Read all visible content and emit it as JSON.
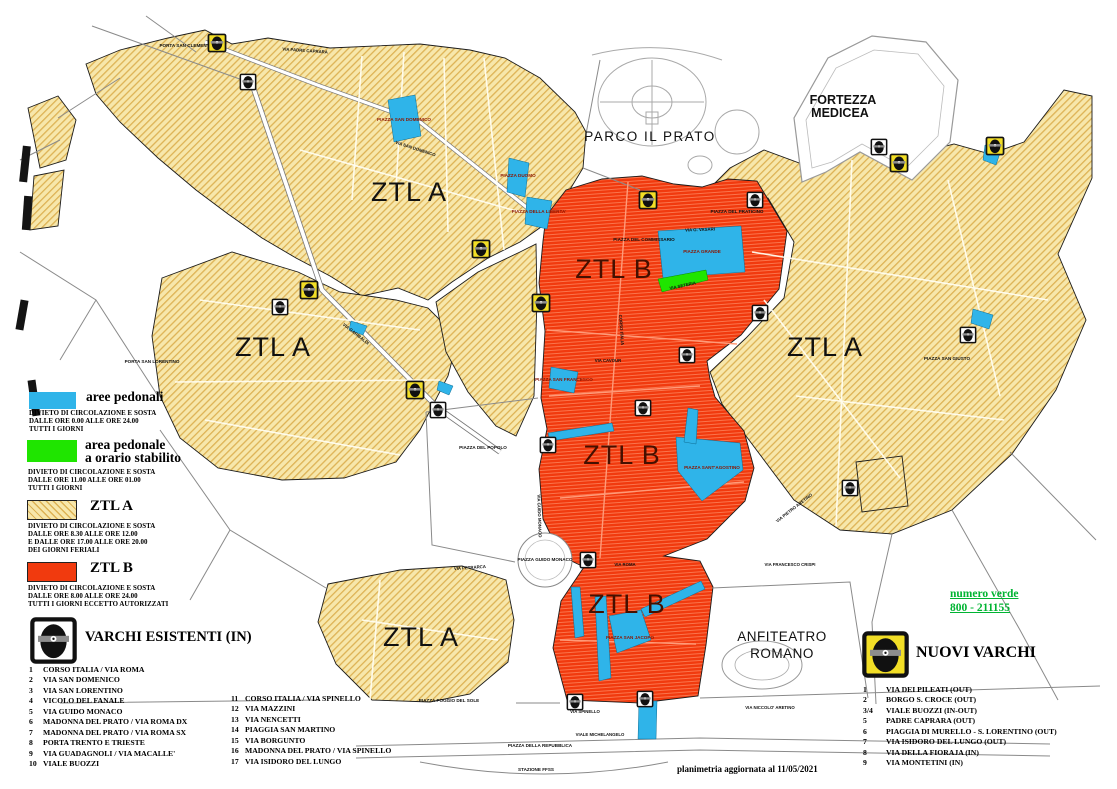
{
  "colors": {
    "aree_pedonali_blue": "#2FB4E9",
    "area_pedonale_green": "#1FE500",
    "ztl_a_yellow": "#F7E7AB",
    "ztl_a_hatch": "#DDB254",
    "ztl_b_red": "#F13A0E",
    "numero_verde_green": "#00B432",
    "varco_icon_bg_existing": "#FFFFFF",
    "varco_icon_bg_new": "#F2DE26"
  },
  "map": {
    "labels": {
      "ztl_a": "ZTL A",
      "ztl_b": "ZTL B",
      "parco": "PARCO  IL  PRATO",
      "fortezza_line1": "FORTEZZA",
      "fortezza_line2": "MEDICEA",
      "anfiteatro_line1": "ANFITEATRO",
      "anfiteatro_line2": "ROMANO"
    },
    "places": [
      "PORTA SAN CLEMENTE",
      "PIAZZA SAN DOMENICO",
      "PIAZZA DUOMO",
      "PIAZZA DELLA LIBERTA'",
      "PIAZZA DEL COMMISSARIO",
      "PIAZZA DEL PRATICINO",
      "PIAZZA GRANDE",
      "PIAZZA SAN FRANCESCO",
      "PIAZZA SANT'AGOSTINO",
      "PIAZZA DEL POPOLO",
      "PIAZZA GUIDO MONACO",
      "PIAZZA SAN JACOPO",
      "PIAZZA DELLA REPUBBLICA",
      "STAZIONE FFSS",
      "PIAZZA POGGIO DEL SOLE",
      "PIAZZA SAN GIUSTO",
      "PORTA SAN LORENTINO"
    ],
    "streets": [
      "VIA PADRE CAPRARA",
      "VIA SAN DOMENICO",
      "VIA GARIBALDI",
      "CORSO ITALIA",
      "VIA G. VASARI",
      "VIA SETERIA",
      "VIA CAVOUR",
      "VIA ROMA",
      "VIA SPINELLO",
      "VIALE MICHELANGELO",
      "VIA PETRARCA",
      "VIA FRANCESCO CRISPI",
      "VIA NICCOLO' ARETINO",
      "VIA PIETRO ARETINO",
      "VIA GUIDO MONACO"
    ]
  },
  "legend": {
    "items": [
      {
        "title": "aree pedonali",
        "lines": [
          "DIVIETO DI CIRCOLAZIONE E SOSTA",
          "DALLE ORE 0.00 ALLE ORE 24.00",
          "TUTTI I GIORNI"
        ]
      },
      {
        "title": "area pedonale",
        "title2": "a orario stabilito",
        "lines": [
          "DIVIETO DI CIRCOLAZIONE E SOSTA",
          "DALLE ORE 11.00 ALLE ORE 01.00",
          "TUTTI I GIORNI"
        ]
      },
      {
        "title": "ZTL A",
        "lines": [
          "DIVIETO DI CIRCOLAZIONE E SOSTA",
          "DALLE ORE 8.30 ALLE ORE 12.00",
          "E DALLE ORE 17.00 ALLE ORE 20.00",
          "DEI GIORNI FERIALI"
        ]
      },
      {
        "title": "ZTL B",
        "lines": [
          "DIVIETO DI CIRCOLAZIONE E SOSTA",
          "DALLE ORE 8.00 ALLE ORE 24.00",
          "TUTTI I GIORNI ECCETTO AUTORIZZATI"
        ]
      }
    ]
  },
  "varchi_esistenti": {
    "title": "VARCHI ESISTENTI (IN)",
    "col1": [
      {
        "n": "1",
        "name": "CORSO ITALIA / VIA ROMA"
      },
      {
        "n": "2",
        "name": "VIA SAN DOMENICO"
      },
      {
        "n": "3",
        "name": "VIA SAN LORENTINO"
      },
      {
        "n": "4",
        "name": "VICOLO DEL FANALE"
      },
      {
        "n": "5",
        "name": "VIA GUIDO MONACO"
      },
      {
        "n": "6",
        "name": "MADONNA DEL PRATO / VIA ROMA DX"
      },
      {
        "n": "7",
        "name": "MADONNA DEL PRATO / VIA ROMA SX"
      },
      {
        "n": "8",
        "name": "PORTA TRENTO E TRIESTE"
      },
      {
        "n": "9",
        "name": "VIA GUADAGNOLI / VIA MACALLE'"
      },
      {
        "n": "10",
        "name": "VIALE BUOZZI"
      }
    ],
    "col2": [
      {
        "n": "11",
        "name": "CORSO ITALIA / VIA SPINELLO"
      },
      {
        "n": "12",
        "name": "VIA MAZZINI"
      },
      {
        "n": "13",
        "name": "VIA NENCETTI"
      },
      {
        "n": "14",
        "name": "PIAGGIA SAN MARTINO"
      },
      {
        "n": "15",
        "name": "VIA BORGUNTO"
      },
      {
        "n": "16",
        "name": "MADONNA DEL PRATO / VIA SPINELLO"
      },
      {
        "n": "17",
        "name": "VIA ISIDORO DEL LUNGO"
      }
    ]
  },
  "nuovi_varchi": {
    "title": "NUOVI VARCHI",
    "items": [
      {
        "n": "1",
        "name": "VIA DEI PILEATI (OUT)"
      },
      {
        "n": "2",
        "name": "BORGO S. CROCE (OUT)"
      },
      {
        "n": "3/4",
        "name": "VIALE BUOZZI (IN-OUT)"
      },
      {
        "n": "5",
        "name": "PADRE CAPRARA (OUT)"
      },
      {
        "n": "6",
        "name": "PIAGGIA DI MURELLO - S. LORENTINO (OUT)"
      },
      {
        "n": "7",
        "name": "VIA ISIDORO DEL LUNGO (OUT)"
      },
      {
        "n": "8",
        "name": "VIA DELLA FIORAJA (IN)"
      },
      {
        "n": "9",
        "name": "VIA MONTETINI (IN)"
      }
    ]
  },
  "numero_verde": {
    "label": "numero verde",
    "number": "800 - 211155"
  },
  "footer": {
    "note": "planimetria aggiornata al 11/05/2021"
  }
}
